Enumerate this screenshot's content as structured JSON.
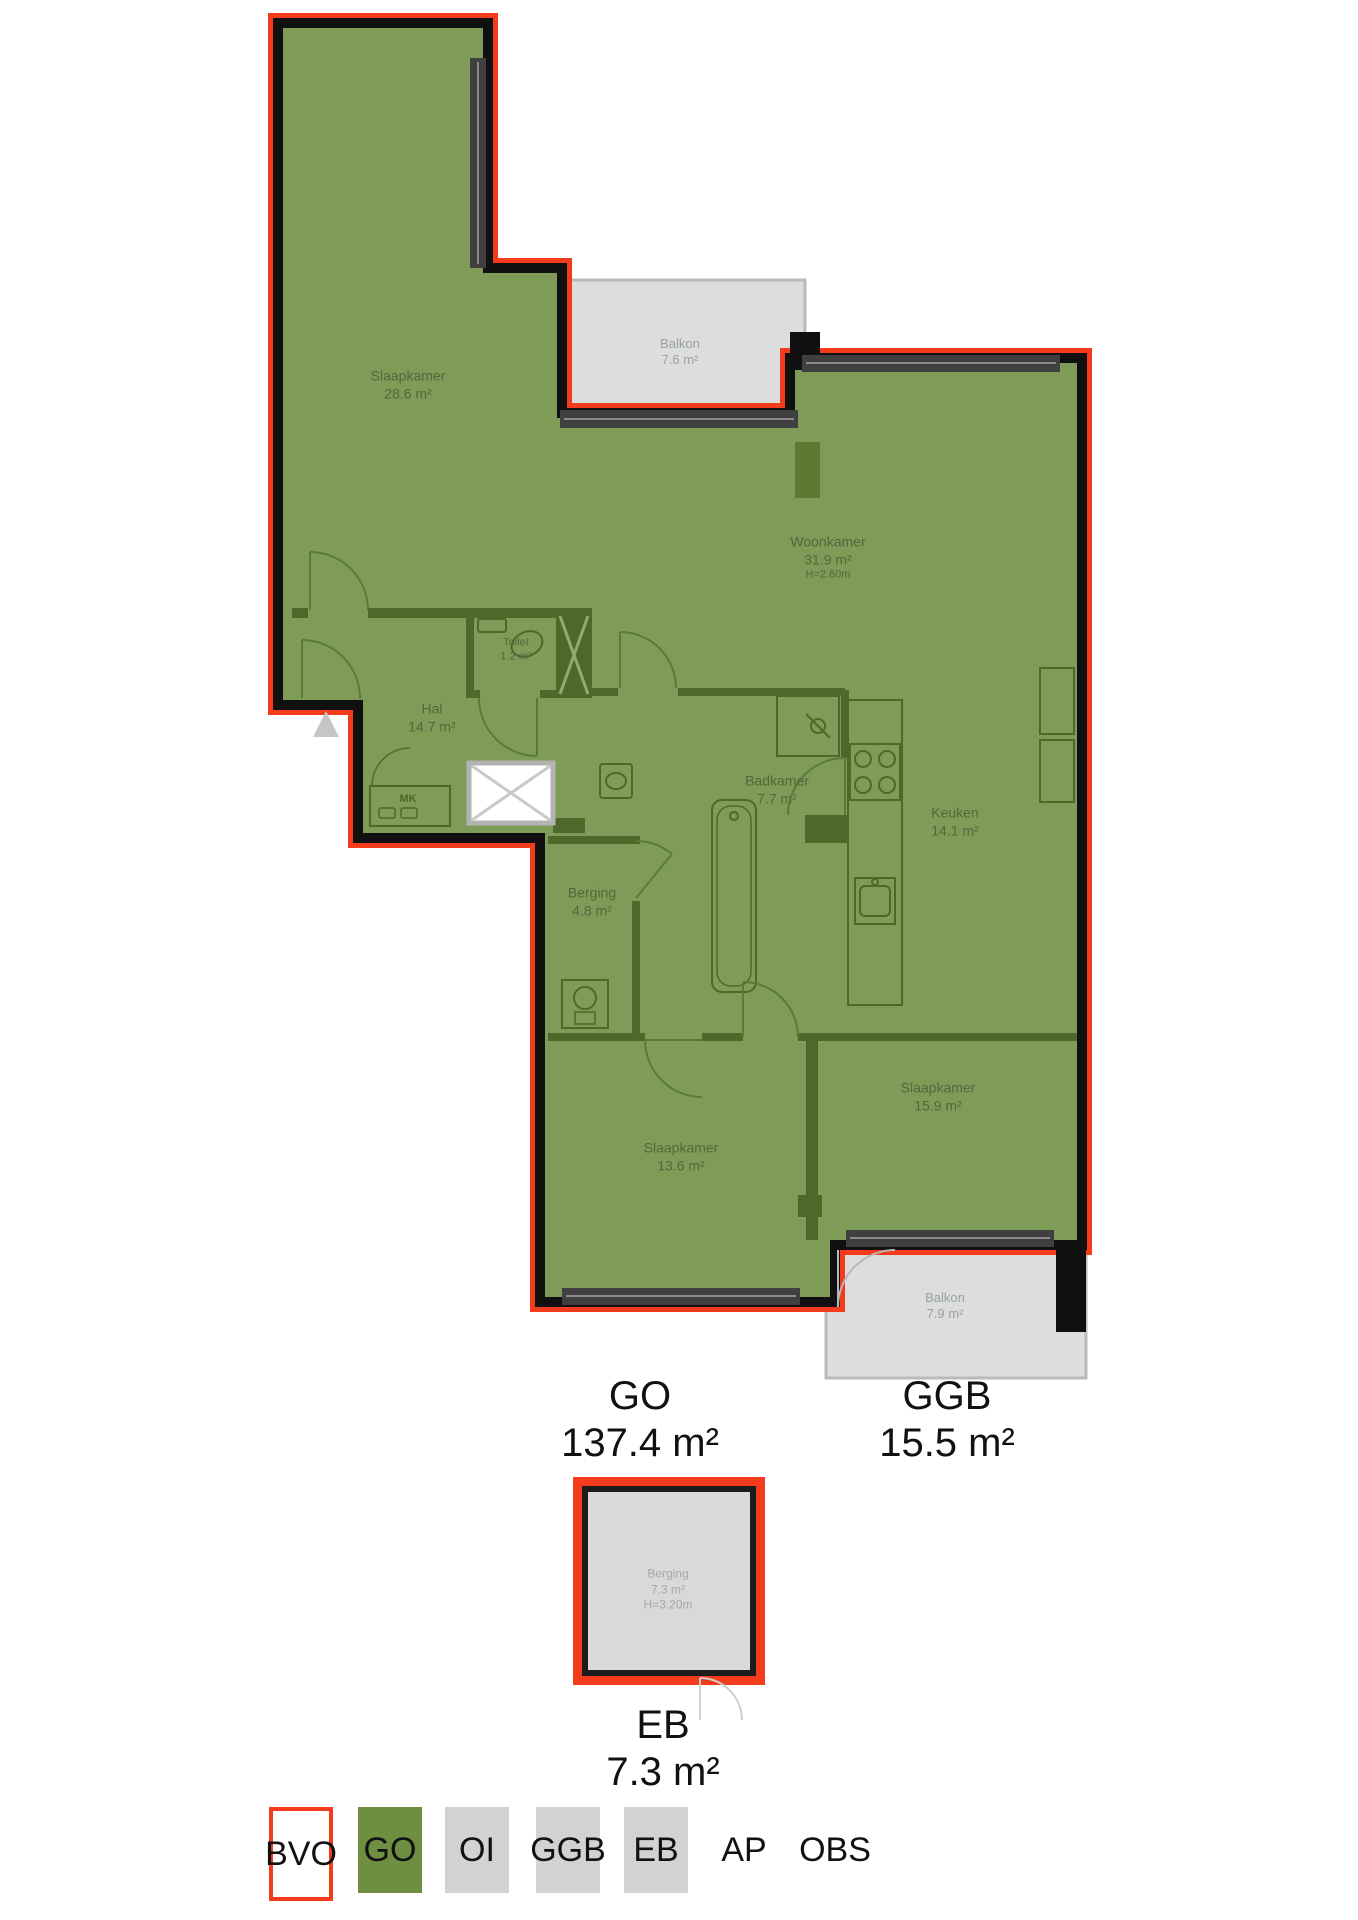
{
  "colors": {
    "bvo_red": "#f43b1c",
    "go_green": "#7f9b58",
    "wall_black": "#101010",
    "interior_wall": "#4d682a",
    "balcony_gray": "#dcdddd",
    "window_gray": "#3f3f3f",
    "legend_gray": "#d2d2d2",
    "legend_go_green": "#6e8e42",
    "room_label_green": "#55663b",
    "balcony_label_gray": "#9ba0a4"
  },
  "rooms": {
    "slaapkamer1": {
      "name": "Slaapkamer",
      "area": "28.6 m²"
    },
    "balkon_top": {
      "name": "Balkon",
      "area": "7.6 m²"
    },
    "woonkamer": {
      "name": "Woonkamer",
      "area": "31.9 m²",
      "height": "H=2.60m"
    },
    "toilet": {
      "name": "Toilet",
      "area": "1.2 m²"
    },
    "hal": {
      "name": "Hal",
      "area": "14.7 m²"
    },
    "mk": {
      "name": "MK"
    },
    "badkamer": {
      "name": "Badkamer",
      "area": "7.7 m²"
    },
    "keuken": {
      "name": "Keuken",
      "area": "14.1 m²"
    },
    "berging": {
      "name": "Berging",
      "area": "4.8 m²"
    },
    "slaapkamer2": {
      "name": "Slaapkamer",
      "area": "15.9 m²"
    },
    "slaapkamer3": {
      "name": "Slaapkamer",
      "area": "13.6 m²"
    },
    "balkon_bottom": {
      "name": "Balkon",
      "area": "7.9 m²"
    },
    "externe_berging": {
      "name": "Berging",
      "area": "7.3 m²",
      "height": "H=3.20m"
    }
  },
  "summaries": {
    "go": {
      "label": "GO",
      "area": "137.4 m²"
    },
    "ggb": {
      "label": "GGB",
      "area": "15.5 m²"
    },
    "eb": {
      "label": "EB",
      "area": "7.3 m²"
    }
  },
  "legend": {
    "items": [
      {
        "label": "BVO"
      },
      {
        "label": "GO"
      },
      {
        "label": "OI"
      },
      {
        "label": "GGB"
      },
      {
        "label": "EB"
      },
      {
        "label": "AP"
      },
      {
        "label": "OBS"
      }
    ]
  }
}
